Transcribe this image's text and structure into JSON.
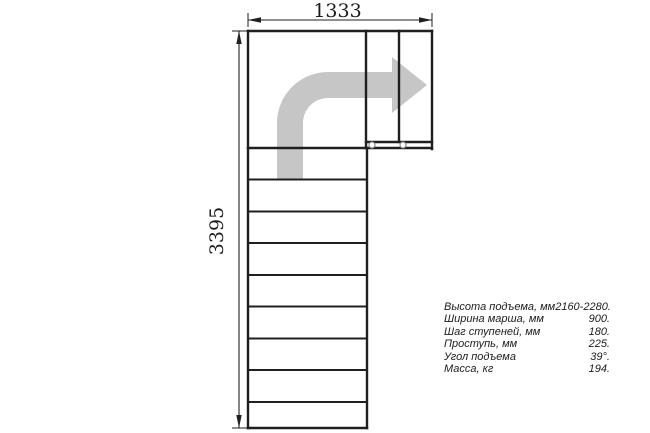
{
  "drawing": {
    "type": "stair-plan-top-view",
    "dimension_width_mm": "1333",
    "dimension_height_mm": "3395"
  },
  "icons": {
    "direction_arrow": "curved-up-right-turn-arrow",
    "post_markers": "small-circle-post-marker"
  },
  "colors": {
    "background": "#ffffff",
    "line": "#1f1f1f",
    "arrow_fill": "#c6c6c6",
    "post_circle_stroke": "#8c8c8c",
    "text": "#1c1c1c"
  },
  "specs": {
    "rows": [
      {
        "label": "Высота подъема, мм",
        "value": "2160-2280."
      },
      {
        "label": "Ширина марша, мм",
        "value": "900."
      },
      {
        "label": "Шаг ступеней, мм",
        "value": "180."
      },
      {
        "label": "Проступь, мм",
        "value": "225."
      },
      {
        "label": "Угол подъема",
        "value": "39°."
      },
      {
        "label": "Масса, кг",
        "value": "194."
      }
    ]
  }
}
